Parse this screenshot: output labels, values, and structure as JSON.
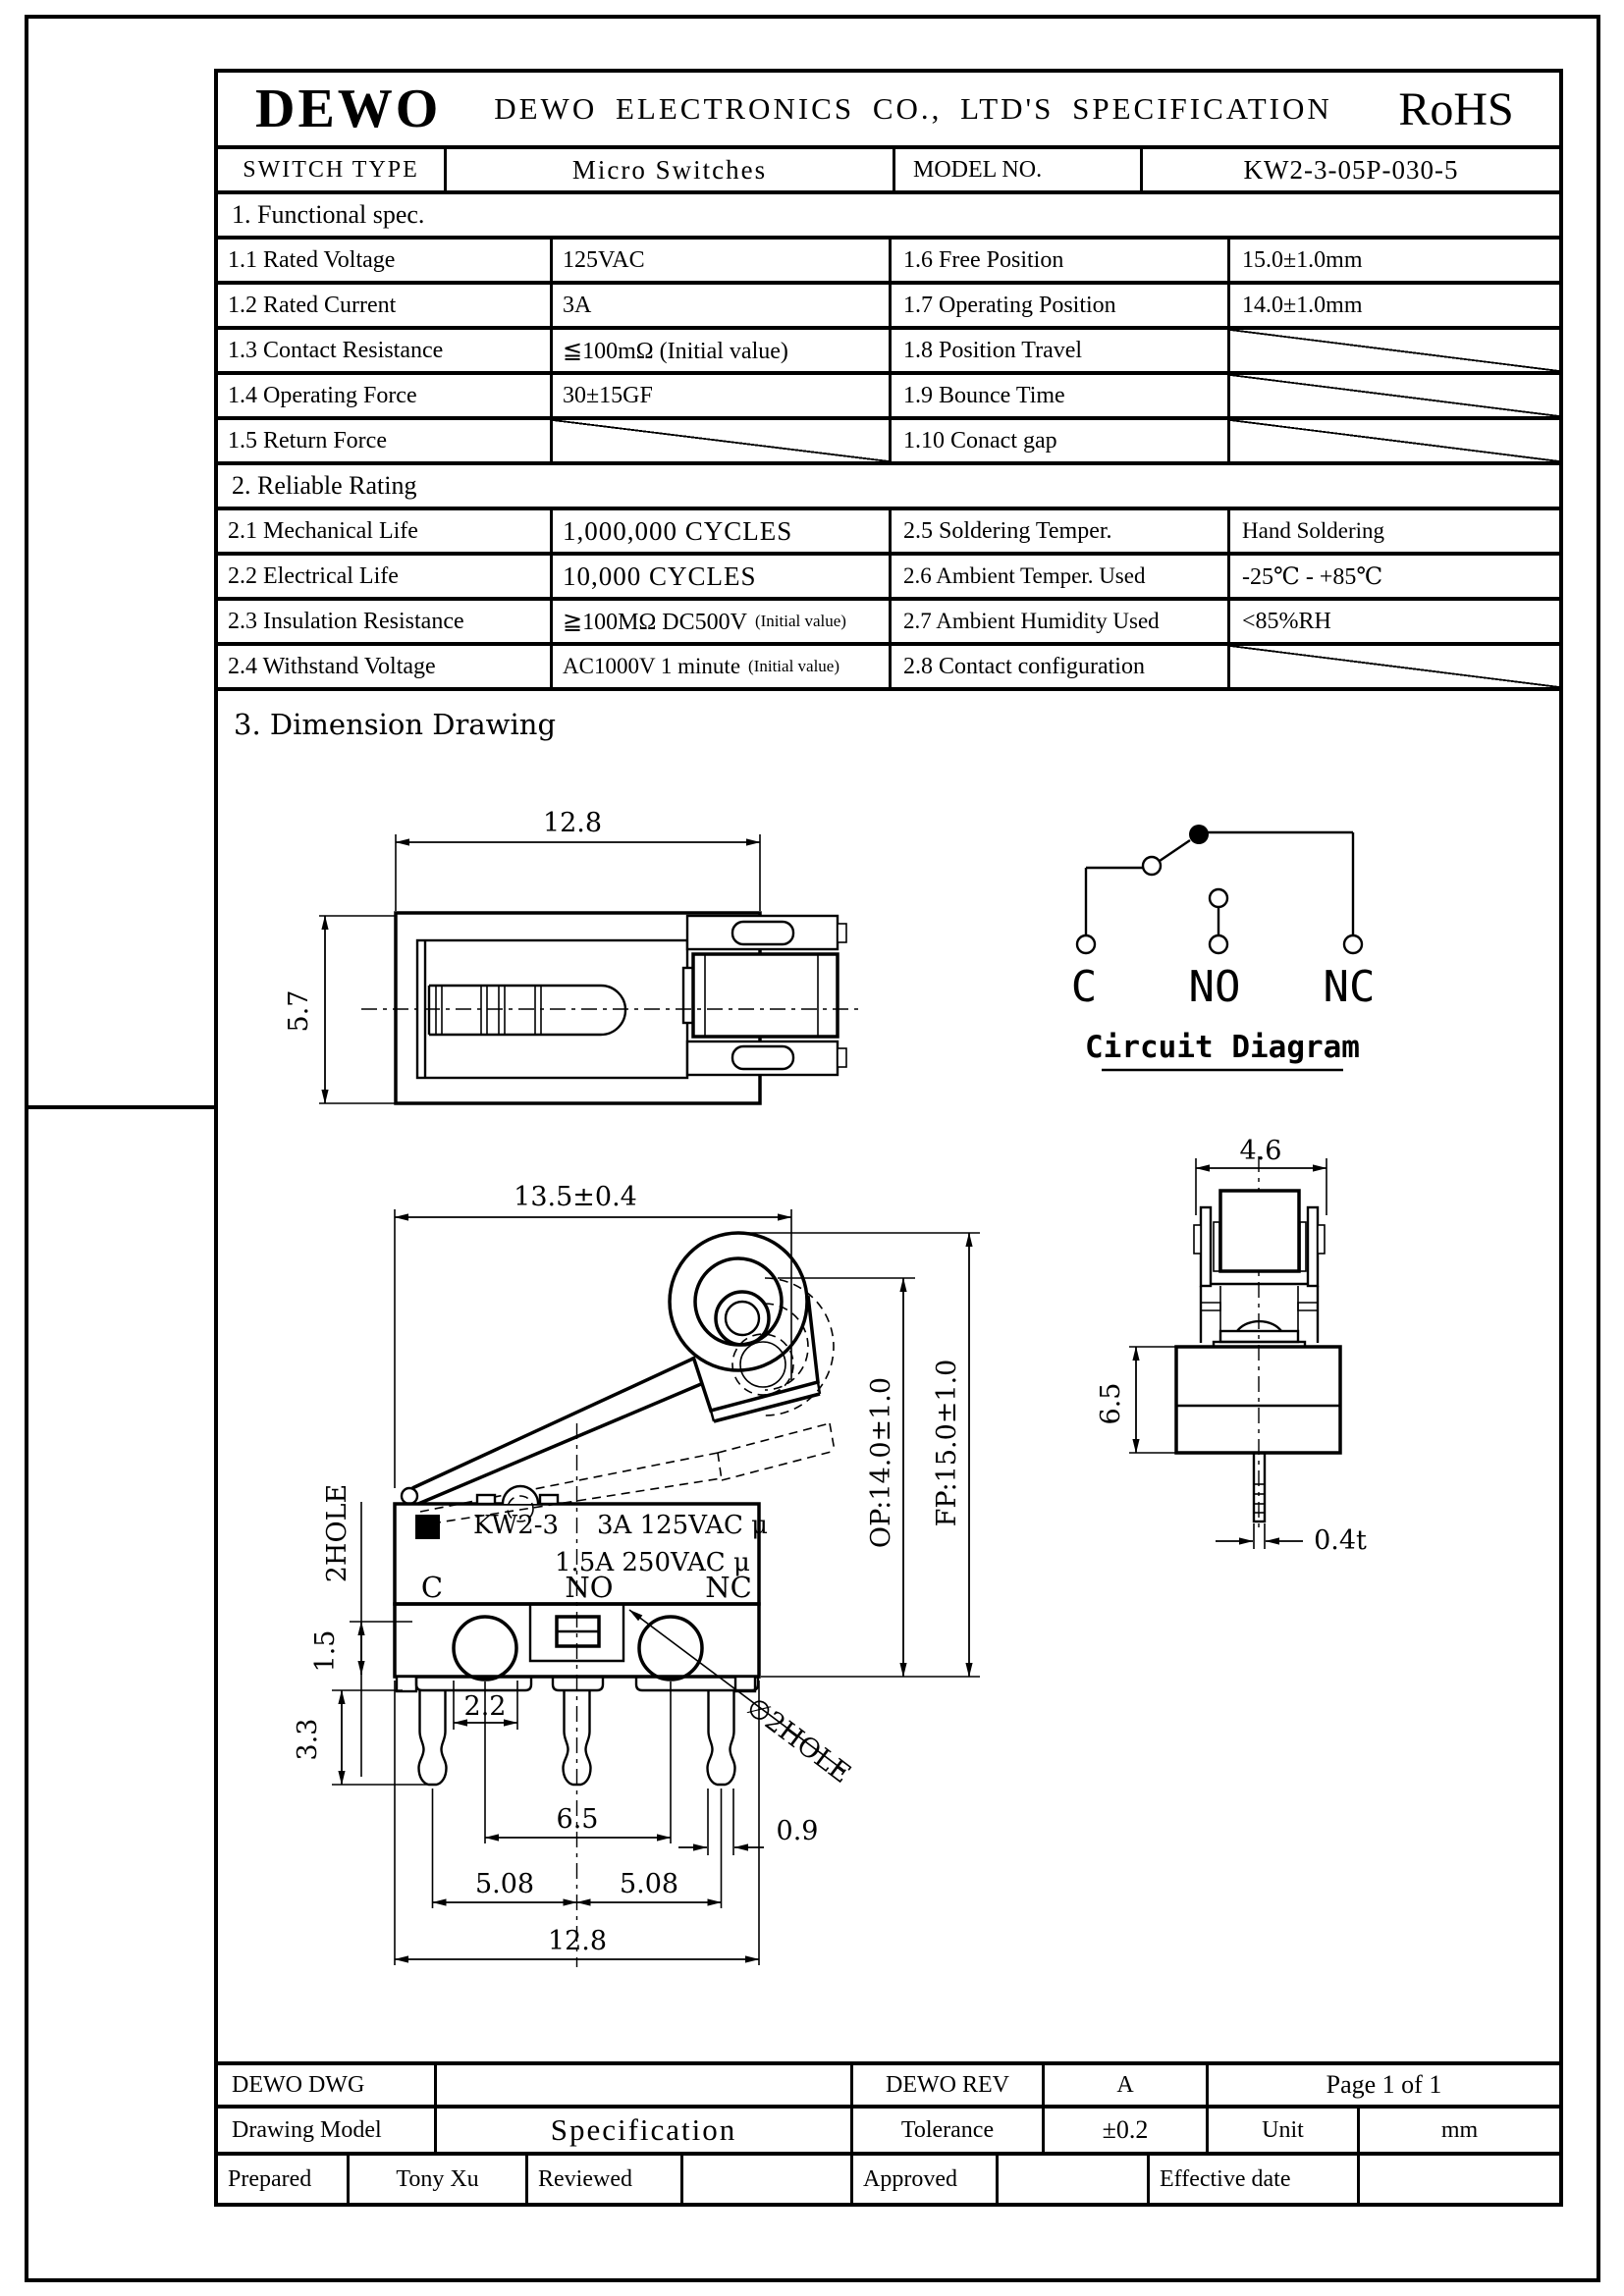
{
  "header": {
    "logo": "DEWO",
    "company": "DEWO ELECTRONICS CO., LTD'S SPECIFICATION",
    "rohs": "RoHS",
    "switch_type_label": "SWITCH TYPE",
    "switch_type_value": "Micro Switches",
    "model_label": "MODEL NO.",
    "model_value": "KW2-3-05P-030-5"
  },
  "functional_spec": {
    "title": "1. Functional spec.",
    "rows": [
      {
        "l1": "1.1 Rated Voltage",
        "v1": "125VAC",
        "l2": "1.6  Free Position",
        "v2": "15.0±1.0mm"
      },
      {
        "l1": "1.2 Rated Current",
        "v1": "3A",
        "l2": "1.7  Operating Position",
        "v2": "14.0±1.0mm"
      },
      {
        "l1": "1.3 Contact Resistance",
        "v1": "≦100mΩ (Initial value)",
        "l2": "1.8  Position Travel",
        "v2": ""
      },
      {
        "l1": "1.4 Operating Force",
        "v1": "30±15GF",
        "l2": "1.9  Bounce Time",
        "v2": ""
      },
      {
        "l1": "1.5 Return Force",
        "v1": "",
        "l2": "1.10 Conact gap",
        "v2": ""
      }
    ]
  },
  "reliable_rating": {
    "title": "2. Reliable Rating",
    "rows": [
      {
        "l1": "2.1 Mechanical Life",
        "v1": "1,000,000 CYCLES",
        "note1": "",
        "l2": "2.5 Soldering Temper.",
        "v2": "Hand Soldering"
      },
      {
        "l1": "2.2 Electrical Life",
        "v1": "10,000  CYCLES",
        "note1": "",
        "l2": "2.6 Ambient Temper. Used",
        "v2": "-25℃ - +85℃"
      },
      {
        "l1": "2.3 Insulation Resistance",
        "v1": "≧100MΩ DC500V",
        "note1": "(Initial value)",
        "l2": "2.7 Ambient Humidity Used",
        "v2": "<85%RH"
      },
      {
        "l1": "2.4  Withstand Voltage",
        "v1": "AC1000V 1 minute",
        "note1": "(Initial value)",
        "l2": "2.8 Contact configuration",
        "v2": ""
      }
    ]
  },
  "drawing": {
    "title": "3. Dimension Drawing",
    "top_view": {
      "width": "12.8",
      "height": "5.7"
    },
    "circuit": {
      "c": "C",
      "no": "NO",
      "nc": "NC",
      "caption": "Circuit Diagram"
    },
    "front_view": {
      "dim_top": "13.5±0.4",
      "two_hole": "2HOLE",
      "logo_mark": "W",
      "mark_model": "KW2-3",
      "mark_r1": "3A 125VAC μ",
      "mark_r2": "1.5A 250VAC μ",
      "term_c": "C",
      "term_no": "NO",
      "term_nc": "NC",
      "d_15": "1.5",
      "d_33": "3.3",
      "d_22": "2.2",
      "d_65": "6.5",
      "d_09": "0.9",
      "d_508l": "5.08",
      "d_508r": "5.08",
      "d_128": "12.8",
      "op": "OP:14.0±1.0",
      "fp": "FP:15.0±1.0",
      "hole_note": "∅2HOLE"
    },
    "side_view": {
      "width": "4.6",
      "height": "6.5",
      "thickness": "0.4t"
    }
  },
  "footer": {
    "dwg_label": "DEWO DWG",
    "dwg_value": "",
    "rev_label": "DEWO REV",
    "rev_value": "A",
    "page": "Page 1 of 1",
    "model_label": "Drawing Model",
    "model_value": "Specification",
    "tol_label": "Tolerance",
    "tol_value": "±0.2",
    "unit_label": "Unit",
    "unit_value": "mm",
    "prepared_label": "Prepared",
    "prepared_value": "Tony Xu",
    "reviewed_label": "Reviewed",
    "reviewed_value": "",
    "approved_label": "Approved",
    "approved_value": "",
    "effective_label": "Effective date",
    "effective_value": ""
  }
}
